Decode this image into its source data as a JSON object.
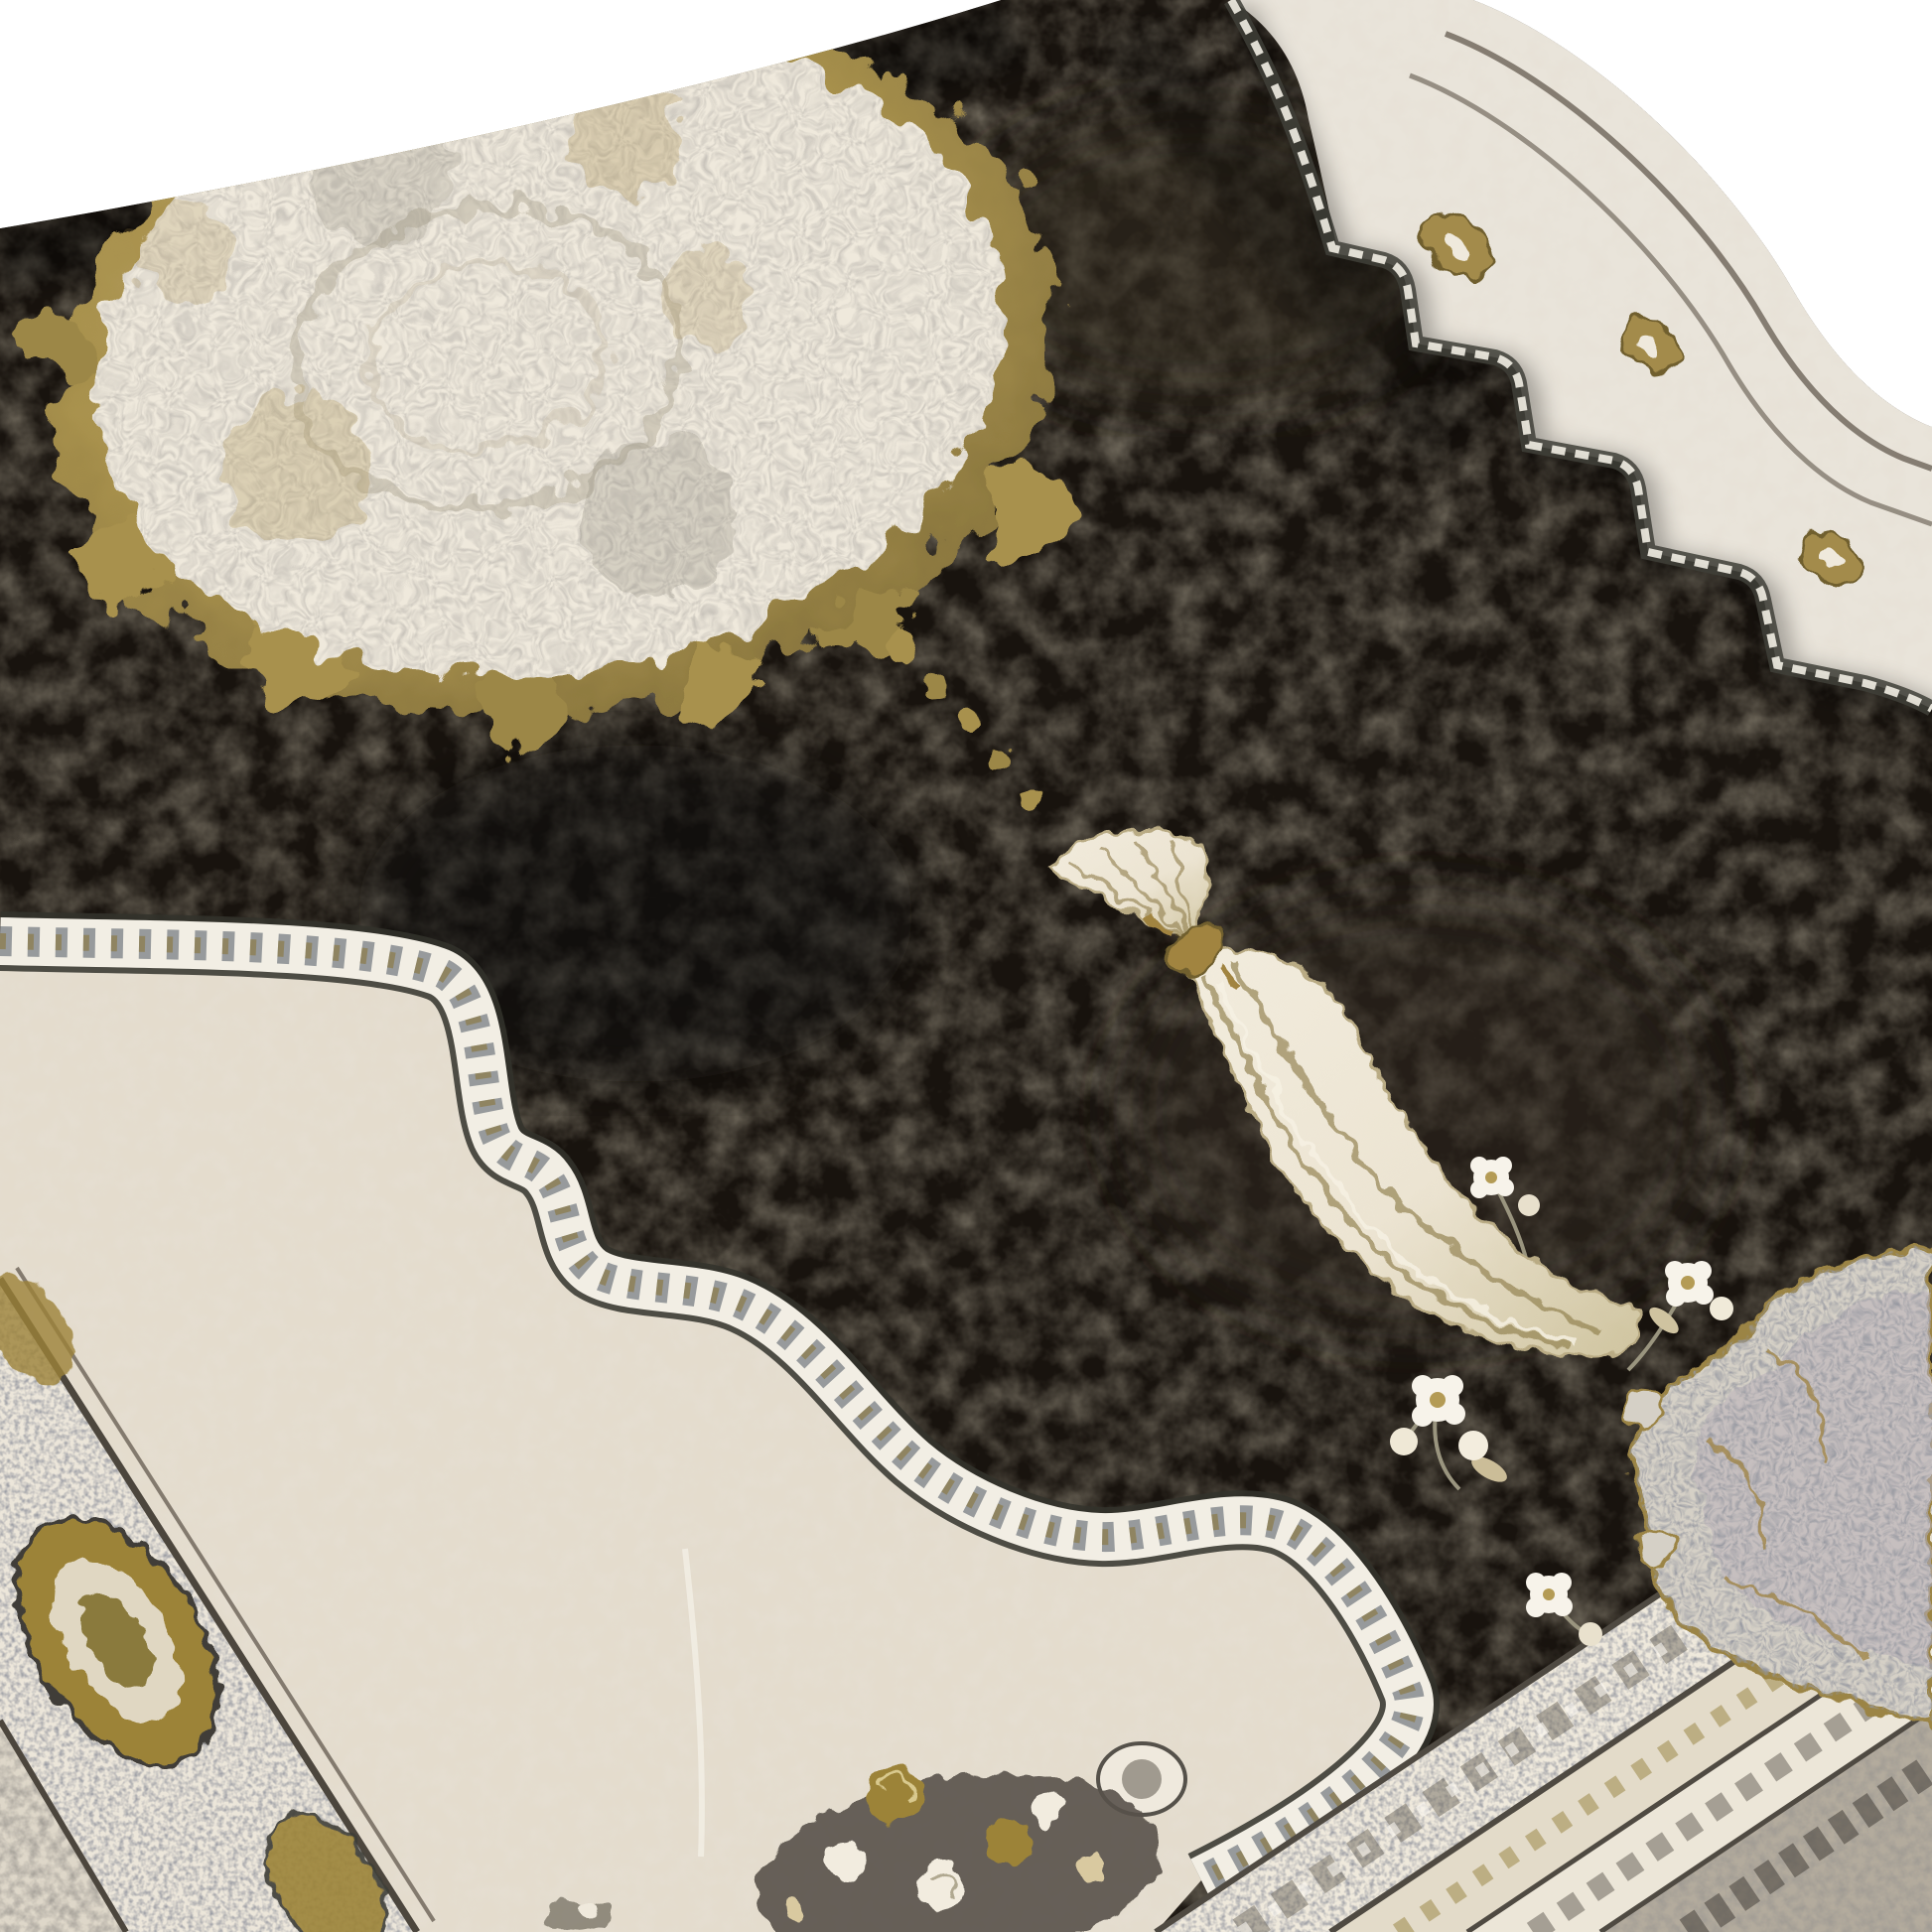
{
  "scene": {
    "title": "Ornate black and cream medallion area rug",
    "description": "Studio product photograph of a distressed black and cream oriental rug with an oversized silver-cream floral medallion edged in gold leaves, a gold-tied tassel pendant on the black field, a scalloped ornate ribbon separating the cream surround, gold rosette border bands along the edges, a grey arabesque corner cartouche, white blossom sprays and a rose bouquet, displayed diagonally on a white background",
    "background": "#ffffff"
  },
  "palette": {
    "background": "#ffffff",
    "field_black": "#18130e",
    "field_mottle": "#342d22",
    "medallion_cream": "#efe9dc",
    "medallion_texture": "#8f887a",
    "gold": "#a8914d",
    "gold_dark": "#7e6c39",
    "gold_light": "#c3ae72",
    "cream_field": "#e4dccd",
    "cream_light": "#f4f0e6",
    "trim_slate": "#4d5560",
    "trim_dark": "#3b3b34",
    "band_cream": "#e9e4da",
    "guard_brown": "#7a7166",
    "rosette_gold": "#a38b4c",
    "spandrel_grey": "#d5d0c6",
    "spandrel_mauve": "#b9b0ba",
    "corner_border": "#b3ab9d",
    "flower_white": "#f7f3ea",
    "flower_center": "#b49b55",
    "foliage": "#57524a",
    "tassel_cream": "#ece4d2",
    "tassel_olive": "#8d7c4a",
    "knot_gold": "#a18441"
  },
  "components": {
    "background": {
      "label": "white studio background"
    },
    "rug": {
      "label": "distressed medallion area rug shown at a diagonal"
    },
    "field": {
      "label": "black distressed central field"
    },
    "medallion": {
      "label": "oversized cream floral medallion with gold leaf fringe"
    },
    "pendant": {
      "label": "cream tassel pendant tied with a gold knot"
    },
    "inner_ribbon": {
      "label": "ornate scalloped ribbon between field and cream surround"
    },
    "cream_surround": {
      "label": "cream inner field along left and bottom"
    },
    "left_border": {
      "label": "left border band with gold oval rosettes"
    },
    "top_right_border": {
      "label": "curved top-right edge border band with guard stripes"
    },
    "right_steps": {
      "label": "stepped scallop boundary on right side"
    },
    "corner_spandrel": {
      "label": "grey arabesque corner cartouche at lower right"
    },
    "corner_borders": {
      "label": "diagonal border stripes across bottom-right corner"
    },
    "flower_sprays": {
      "label": "white blossom sprays on the black field",
      "count": 4
    },
    "bouquet": {
      "label": "gold and white rose bouquet at the bottom edge"
    },
    "rosettes": {
      "count": 3
    }
  }
}
